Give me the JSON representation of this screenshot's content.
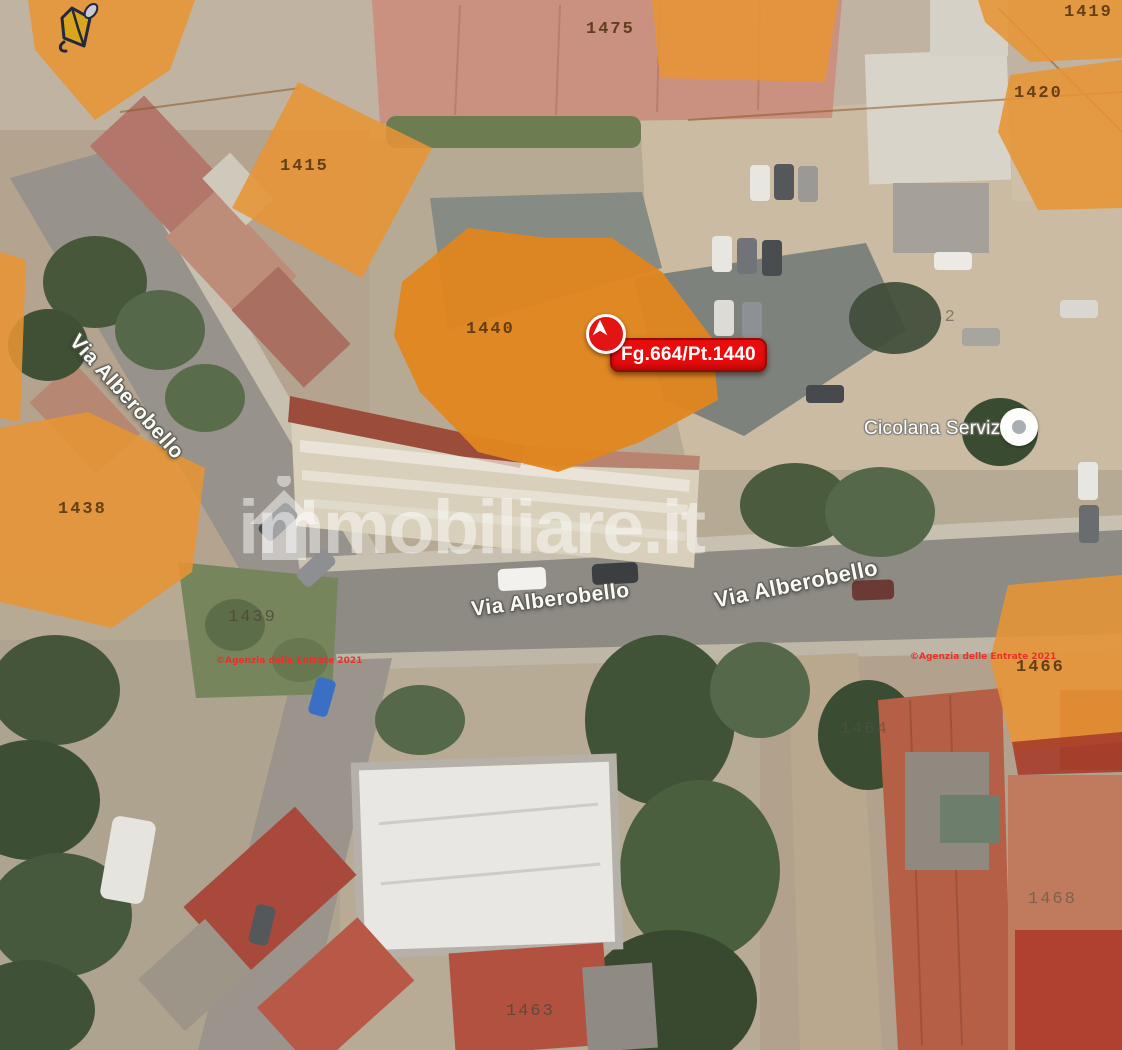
{
  "watermark": {
    "text": "immobiliare.it"
  },
  "marker": {
    "label": "Fg.664/Pt.1440"
  },
  "poi": {
    "name": "Cicolana Servizi"
  },
  "streets": {
    "s1": "Via Alberobello",
    "s2": "Via Alberobello",
    "s3": "Via Alberobello"
  },
  "attribution": {
    "left": "©Agenzia delle Entrate 2021",
    "right": "©Agenzia delle Entrate 2021"
  },
  "parcels": {
    "p1475": "1475",
    "p1419": "1419",
    "p1420": "1420",
    "p1415": "1415",
    "p1440": "1440",
    "p1442": "1442",
    "p1438": "1438",
    "p1439": "1439",
    "p1464": "1464",
    "p1466": "1466",
    "p1468": "1468",
    "p1463": "1463"
  },
  "colors": {
    "parcel_fill": "#e79434",
    "subject_parcel_fill": "#e0861e",
    "parcel_strip_red": "#a63d2b",
    "marker_red": "#ea0c0c",
    "attribution_red": "#e8312a"
  }
}
